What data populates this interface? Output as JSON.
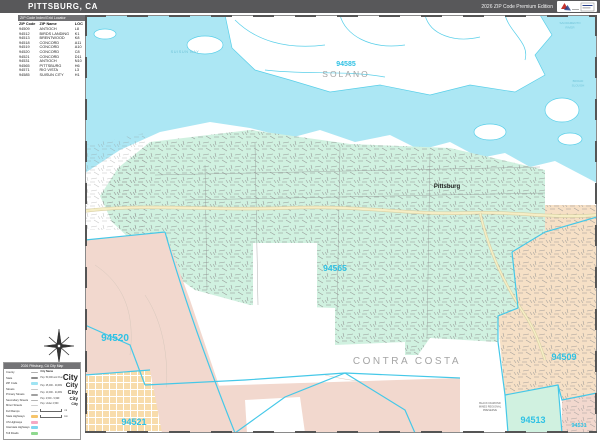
{
  "header": {
    "title": "PITTSBURG, CA",
    "edition": "2026 ZIP Code Premium Edition"
  },
  "zip_index": {
    "title": "ZIP Code Index/Grid Locator",
    "columns": [
      "ZIP Code",
      "ZIP Name",
      "LOC"
    ],
    "rows": [
      {
        "zip": "94509",
        "name": "ANTIOCH",
        "loc": "L8"
      },
      {
        "zip": "94512",
        "name": "BIRDS LANDING",
        "loc": "K1"
      },
      {
        "zip": "94513",
        "name": "BRENTWOOD",
        "loc": "K8"
      },
      {
        "zip": "94518",
        "name": "CONCORD",
        "loc": "A11"
      },
      {
        "zip": "94519",
        "name": "CONCORD",
        "loc": "A10"
      },
      {
        "zip": "94520",
        "name": "CONCORD",
        "loc": "C8"
      },
      {
        "zip": "94521",
        "name": "CONCORD",
        "loc": "D11"
      },
      {
        "zip": "94531",
        "name": "ANTIOCH",
        "loc": "N10"
      },
      {
        "zip": "94565",
        "name": "PITTSBURG",
        "loc": "H6"
      },
      {
        "zip": "94571",
        "name": "RIO VISTA",
        "loc": "L3"
      },
      {
        "zip": "94585",
        "name": "SUISUN CITY",
        "loc": "H1"
      }
    ]
  },
  "map": {
    "labels": {
      "solano": "SOLANO",
      "contra_costa": "CONTRA COSTA",
      "pittsburg": "Pittsburg",
      "z94585": "94585",
      "z94565": "94565",
      "z94520": "94520",
      "z94521": "94521",
      "z94509": "94509",
      "z94513": "94513",
      "z94531": "94531",
      "suisun_bay": "SUISUN BAY",
      "sacramento": "SACRAMENTO",
      "river": "RIVER",
      "broad": "BROAD",
      "slough": "SLOUGH",
      "black_diamond_1": "BLACK DIAMOND",
      "black_diamond_2": "MINES REGIONAL",
      "black_diamond_3": "PRESERVE"
    }
  },
  "legend": {
    "title": "2026 Pittsburg, CA City Map",
    "city_header": "City Name",
    "line_items": [
      {
        "label": "County",
        "color": "#b0b0b0",
        "h": 1
      },
      {
        "label": "State",
        "color": "#8c8c8c",
        "h": 2
      },
      {
        "label": "ZIP Code",
        "color": "#9fe4f3",
        "h": 3
      },
      {
        "label": "Streets",
        "color": "#c8c8c8",
        "h": 1
      },
      {
        "label": "Primary Streets",
        "color": "#a0a0a0",
        "h": 2
      },
      {
        "label": "Secondary Streets",
        "color": "#b4b4b4",
        "h": 1
      },
      {
        "label": "Minor Streets",
        "color": "#d0d0d0",
        "h": 1
      },
      {
        "label": "Full Ramps",
        "color": "#c0c0c0",
        "h": 1
      },
      {
        "label": "State Highways",
        "color": "#f6c46a",
        "h": 3
      },
      {
        "label": "US Highways",
        "color": "#f5a9c4",
        "h": 3
      },
      {
        "label": "Interstate Highways",
        "color": "#7fd6ef",
        "h": 3
      },
      {
        "label": "Toll Roads",
        "color": "#8fd98f",
        "h": 3
      }
    ],
    "city_sizes": [
      {
        "label": "Pop. 50,000 and Over",
        "sample": "City",
        "size": 8
      },
      {
        "label": "Pop. 25,000 - 49,999",
        "sample": "City",
        "size": 6.5
      },
      {
        "label": "Pop. 10,000 - 24,999",
        "sample": "City",
        "size": 5.5
      },
      {
        "label": "Pop. 2,500 - 9,999",
        "sample": "City",
        "size": 4.5
      },
      {
        "label": "Pop. Under 2,500",
        "sample": "City",
        "size": 3.5
      }
    ],
    "scale": [
      {
        "label": "mi"
      },
      {
        "label": "km"
      }
    ]
  },
  "colors": {
    "header_bg": "#58585a",
    "water": "#ace7f4",
    "mint_city": "#d0f1e0",
    "pink_zip": "#f2d8ce",
    "peach_zip": "#f6e0c6",
    "peach_blocks": "#f8dcab",
    "zip_label": "#2fc1e4",
    "county_label": "#a5a5a5",
    "zip_boundary": "#45c8e8",
    "highway_yellow": "#f5eec6"
  }
}
